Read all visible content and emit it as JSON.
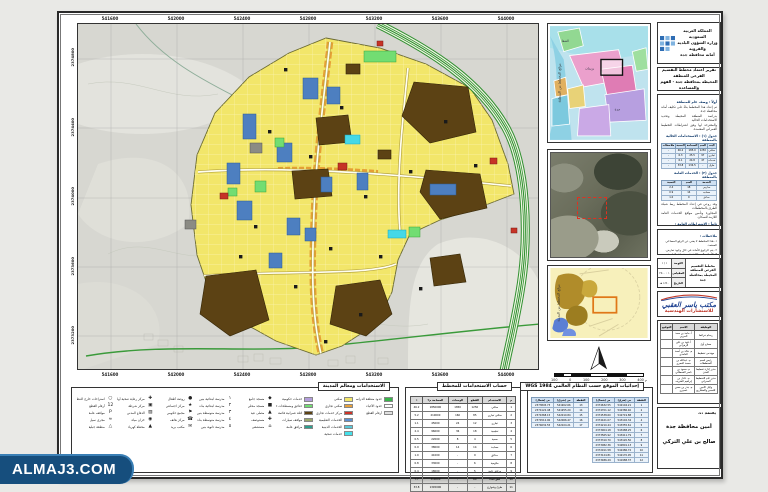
{
  "watermark": {
    "text": "ALMAJ3.COM",
    "bg": "#164e7d"
  },
  "map": {
    "top_labels": [
      "541600",
      "542000",
      "542400",
      "542800",
      "543200",
      "543600",
      "544000"
    ],
    "bottom_labels": [
      "541600",
      "542000",
      "542400",
      "542800",
      "543200",
      "543600",
      "544000"
    ],
    "left_labels": [
      "2374800",
      "2374400",
      "2374000",
      "2373600",
      "2373200"
    ]
  },
  "minimaps": {
    "keymap_caption": "موقع المخطط من المنطقة",
    "satellite_caption": "صورة جوية للموقع",
    "context_caption": "موقع المخطط من المدينة",
    "scale_labels": [
      "100",
      "0",
      "100",
      "200",
      "300",
      "400 م"
    ]
  },
  "header": {
    "lines": [
      "المملكة العربية السعودية",
      "وزارة الشؤون البلدية والقروية",
      "أمانة محافظة جدة"
    ]
  },
  "title_box": {
    "lines": [
      "تقرير اعتماد مخطط التقسيم الفرعي للمنطقة",
      "المحيطة بمحافظة جدة - الفهم والمساعدة"
    ]
  },
  "doc": {
    "h1": "أولاً : وصف عام للمنطقة",
    "p1": [
      "تم إعداد هذا المخطط بناءً على تكليف أمانة محافظة جدة",
      "بدراسة المنطقة المحيطة وتحديد الاستخدامات الحالية",
      "والمقترحة لها وفق اشتراطات التخطيط العمراني المعتمدة."
    ],
    "t1_title": "جدول (١) : الاستخدامات الحالية بالمنطقة",
    "table1": {
      "headers": [
        "البند",
        "العدد",
        "المساحة",
        "النسبة",
        "ملاحظات"
      ],
      "rows": [
        [
          "سكني",
          "1250",
          "185.0",
          "46.2",
          "-"
        ],
        [
          "تجاري",
          "97",
          "25.5",
          "6.3",
          "-"
        ],
        [
          "خدمات",
          "47",
          "24.8",
          "6.1",
          "-"
        ],
        [
          "طرق",
          "-",
          "134.5",
          "33.8",
          "-"
        ]
      ]
    },
    "t2_title": "جدول (٢) : الخدمات العامة بالمنطقة",
    "table2": {
      "headers": [
        "الخدمة",
        "العدد",
        "النسبة"
      ],
      "rows": [
        [
          "مدارس",
          "18",
          "2.4"
        ],
        [
          "مساجد",
          "14",
          "0.9"
        ],
        [
          "حدائق",
          "9",
          "1.0"
        ]
      ]
    },
    "p2": [
      "وقد روعي في إعداد المخطط ربط شبكة الطرق بالمخططات",
      "المجاورة وتأمين مواقع الخدمات العامة اللازمة للسكان."
    ],
    "h2": "ثانياً : الاشتراطات العامة :",
    "bullets": [
      "- نسبة البناء لا تتجاوز ٦٠٪ من مساحة الأرض.",
      "- الارتفاع المسموح به دورين وملحق.",
      "- الارتدادات حسب اشتراطات الأمانة.",
      "- يخصص موقف سيارة لكل وحدة سكنية.",
      "- تطبق اشتراطات كود البناء السعودي.",
      "- لا يجوز تجزئة القطع إلا بموافقة الأمانة.",
      "- تخصص الأدوار الأرضية على الشوارع التجارية.",
      "- يراعى تنسيق الموقع العام والتشجير."
    ]
  },
  "notes": {
    "title": "ملاحظات :",
    "lines": [
      "١- هذا المخطط لا يغني عن الرفع المساحي المعتمد.",
      "٢- يتم الرجوع للأمانة في حال وجود تعارض.",
      "٣- الأبعاد والمساحات تقريبية وفق الطبيعة.",
      "٤- يعتمد المخطط بعد توقيع الجهات المختصة."
    ]
  },
  "tblock": {
    "title": "مخطط التقسيم الفرعي للمنطقة المحيطة بمحافظة جدة",
    "rows": [
      [
        "اللوحة",
        "١ / ١"
      ],
      [
        "المقياس",
        "١ : ٢٥٠٠"
      ],
      [
        "التاريخ",
        "١٤٤٠ هـ"
      ]
    ]
  },
  "firm": {
    "name": "مكتب ياسر العقبي",
    "sub": "للاستشارات الهندسية"
  },
  "signatures": {
    "headers": [
      "الوظيفة",
      "الاسم",
      "التوقيع"
    ],
    "rows": [
      [
        "رسام خرائط",
        "أ. ماجد بن سعد الحربي",
        ""
      ],
      [
        "مساح أول",
        "أ. فهد بن علي الزهراني",
        ""
      ],
      [
        "مهندس تخطيط",
        "م. خالد بن أحمد الغامدي",
        ""
      ],
      [
        "رئيس قسم المخططات",
        "م. عبدالله بن محمد العمري",
        ""
      ],
      [
        "مدير إدارة تخطيط المدن",
        "م. سعود بن ناصر القحطاني",
        ""
      ],
      [
        "مدير عام التخطيط العمراني",
        "م. عادل بن إبراهيم الشريف",
        ""
      ],
      [
        "وكيل الأمين للتعمير والمشاريع",
        "م. بندر بن حسن عسيري",
        ""
      ]
    ]
  },
  "approval": {
    "l1": "يعتمد ،،،",
    "l2": "أمين محافظة جدة",
    "l3": "صالح بن علي التركي"
  },
  "legend": {
    "title": "الاستخدامات ومعالم المدينة",
    "borders": [
      {
        "c": "#39b54a",
        "l": "حدود منطقة الدراسة"
      },
      {
        "c": "#ffffff",
        "l": "حدود الأحياء"
      },
      {
        "c": "#e0e0e0",
        "l": "أرقام القطع"
      }
    ],
    "colors1": [
      {
        "c": "#f2e66a",
        "l": "سكني"
      },
      {
        "c": "#e8a13c",
        "l": "سكني تجاري"
      },
      {
        "c": "#cc3327",
        "l": "مركز خدمات تجاري"
      },
      {
        "c": "#5b8fd0",
        "l": "الخدمات التعليمية"
      },
      {
        "c": "#58c8d8",
        "l": "الخدمات الدينية"
      },
      {
        "c": "#45e0ea",
        "l": "خدمات صحية"
      }
    ],
    "colors2": [
      {
        "c": "#b39ddb",
        "l": "خدمات حكومية"
      },
      {
        "c": "#72dd72",
        "l": "حدائق ومسطحات خضراء"
      },
      {
        "c": "#5c4214",
        "l": "كتلة عمرانية قائمة"
      },
      {
        "c": "#9aa86a",
        "l": "مواقف سيارات"
      },
      {
        "c": "#2e9e8e",
        "l": "مرافق عامة"
      }
    ],
    "sym1": [
      {
        "i": "◆",
        "l": "مسجد جامع"
      },
      {
        "i": "■",
        "l": "مسجد محلي"
      },
      {
        "i": "▲",
        "l": "مصلى عيد"
      },
      {
        "i": "✚",
        "l": "مستوصف"
      },
      {
        "i": "⌂",
        "l": "مستشفى"
      }
    ],
    "sym2": [
      {
        "i": "١",
        "l": "مدرسة ابتدائية بنين"
      },
      {
        "i": "٢",
        "l": "مدرسة ابتدائية بنات"
      },
      {
        "i": "٣",
        "l": "مدرسة متوسطة بنين"
      },
      {
        "i": "٤",
        "l": "مدرسة متوسطة بنات"
      },
      {
        "i": "٥",
        "l": "مدرسة ثانوية بنين"
      }
    ],
    "sym3": [
      {
        "i": "●",
        "l": "روضة أطفال"
      },
      {
        "i": "★",
        "l": "مركز اجتماعي"
      },
      {
        "i": "⚑",
        "l": "مجمع حكومي"
      },
      {
        "i": "☎",
        "l": "مركز هاتف"
      },
      {
        "i": "✉",
        "l": "مكتب بريد"
      }
    ],
    "sym4": [
      {
        "i": "✚",
        "l": "مركز رعاية صحية أولية"
      },
      {
        "i": "▣",
        "l": "مركز شرطة"
      },
      {
        "i": "▨",
        "l": "الدفاع المدني"
      },
      {
        "i": "◉",
        "l": "خزان مياه"
      },
      {
        "i": "▲",
        "l": "محطة كهرباء"
      }
    ],
    "symL": [
      {
        "i": "○",
        "l": "استراحات خارج التنظيم"
      },
      {
        "i": "12",
        "l": "أرقام القطع"
      },
      {
        "i": "P",
        "l": "مواقف عامة"
      },
      {
        "i": "≈",
        "l": "مجرى سيل"
      },
      {
        "i": "△",
        "l": "منطقة جبلية"
      }
    ]
  },
  "uses_table": {
    "title": "حساب الاستخدامات للمخطط",
    "headers": [
      "م",
      "الاستخدام",
      "القطع",
      "الوحدات",
      "المساحة م٢",
      "٪"
    ],
    "rows": [
      [
        "1",
        "سكني",
        "1250",
        "1850",
        "1850000",
        "46.2"
      ],
      [
        "2",
        "سكني تجاري",
        "85",
        "160",
        "210000",
        "5.2"
      ],
      [
        "3",
        "تجاري",
        "12",
        "24",
        "45000",
        "1.1"
      ],
      [
        "4",
        "تعليمية",
        "18",
        "36",
        "96000",
        "2.4"
      ],
      [
        "5",
        "صحية",
        "4",
        "8",
        "22000",
        "0.5"
      ],
      [
        "6",
        "مساجد",
        "14",
        "14",
        "38000",
        "0.9"
      ],
      [
        "7",
        "حدائق",
        "9",
        "-",
        "41000",
        "1.0"
      ],
      [
        "8",
        "حكومية",
        "6",
        "-",
        "33000",
        "0.8"
      ],
      [
        "9",
        "مرافق عامة",
        "5",
        "-",
        "18000",
        "0.4"
      ],
      [
        "10",
        "قطع فضاء",
        "60",
        "-",
        "310000",
        "7.7"
      ],
      [
        "11",
        "طرق وشوارع",
        "-",
        "-",
        "1345000",
        "33.8"
      ]
    ],
    "total": [
      "",
      "الإجمالي",
      "1463",
      "2092",
      "4008000",
      "100"
    ]
  },
  "coords": {
    "title": "إحداثيات الموقع حسب النظام العالمي WGS 1984",
    "tA": {
      "headers": [
        "النقطة",
        "س (شرق)",
        "ص (شمال)"
      ],
      "rows": [
        [
          "1",
          "542104.21",
          "2374632.55"
        ],
        [
          "2",
          "542386.40",
          "2374701.12"
        ],
        [
          "3",
          "542719.88",
          "2374538.60"
        ],
        [
          "4",
          "543102.34",
          "2374421.07"
        ],
        [
          "5",
          "543355.61",
          "2374210.44"
        ],
        [
          "6",
          "543488.25",
          "2373904.18"
        ],
        [
          "7",
          "543411.79",
          "2373565.92"
        ],
        [
          "8",
          "543120.50",
          "2373310.70"
        ],
        [
          "9",
          "542801.13",
          "2373082.36"
        ],
        [
          "10",
          "542486.72",
          "2372911.58"
        ],
        [
          "11",
          "542170.95",
          "2373124.81"
        ],
        [
          "12",
          "541988.37",
          "2373486.29"
        ]
      ]
    },
    "tB": {
      "headers": [
        "النقطة",
        "س (شرق)",
        "ص (شمال)"
      ],
      "rows": [
        [
          "13",
          "541902.66",
          "2373845.73"
        ],
        [
          "14",
          "541955.20",
          "2374122.48"
        ],
        [
          "15",
          "542010.84",
          "2374368.15"
        ],
        [
          "16",
          "542066.47",
          "2374512.90"
        ],
        [
          "17",
          "542104.21",
          "2374632.55"
        ]
      ]
    }
  },
  "colors": {
    "residential_yellow": "#f2e66a",
    "commercial_orange": "#e59f35",
    "built_brown": "#5c4214",
    "education_blue": "#4d7fc0",
    "health_cyan": "#45d8e8",
    "parks_green": "#72dd72",
    "highway_green": "#2f8f2f",
    "terrain_gray": "#d7d7d1"
  }
}
